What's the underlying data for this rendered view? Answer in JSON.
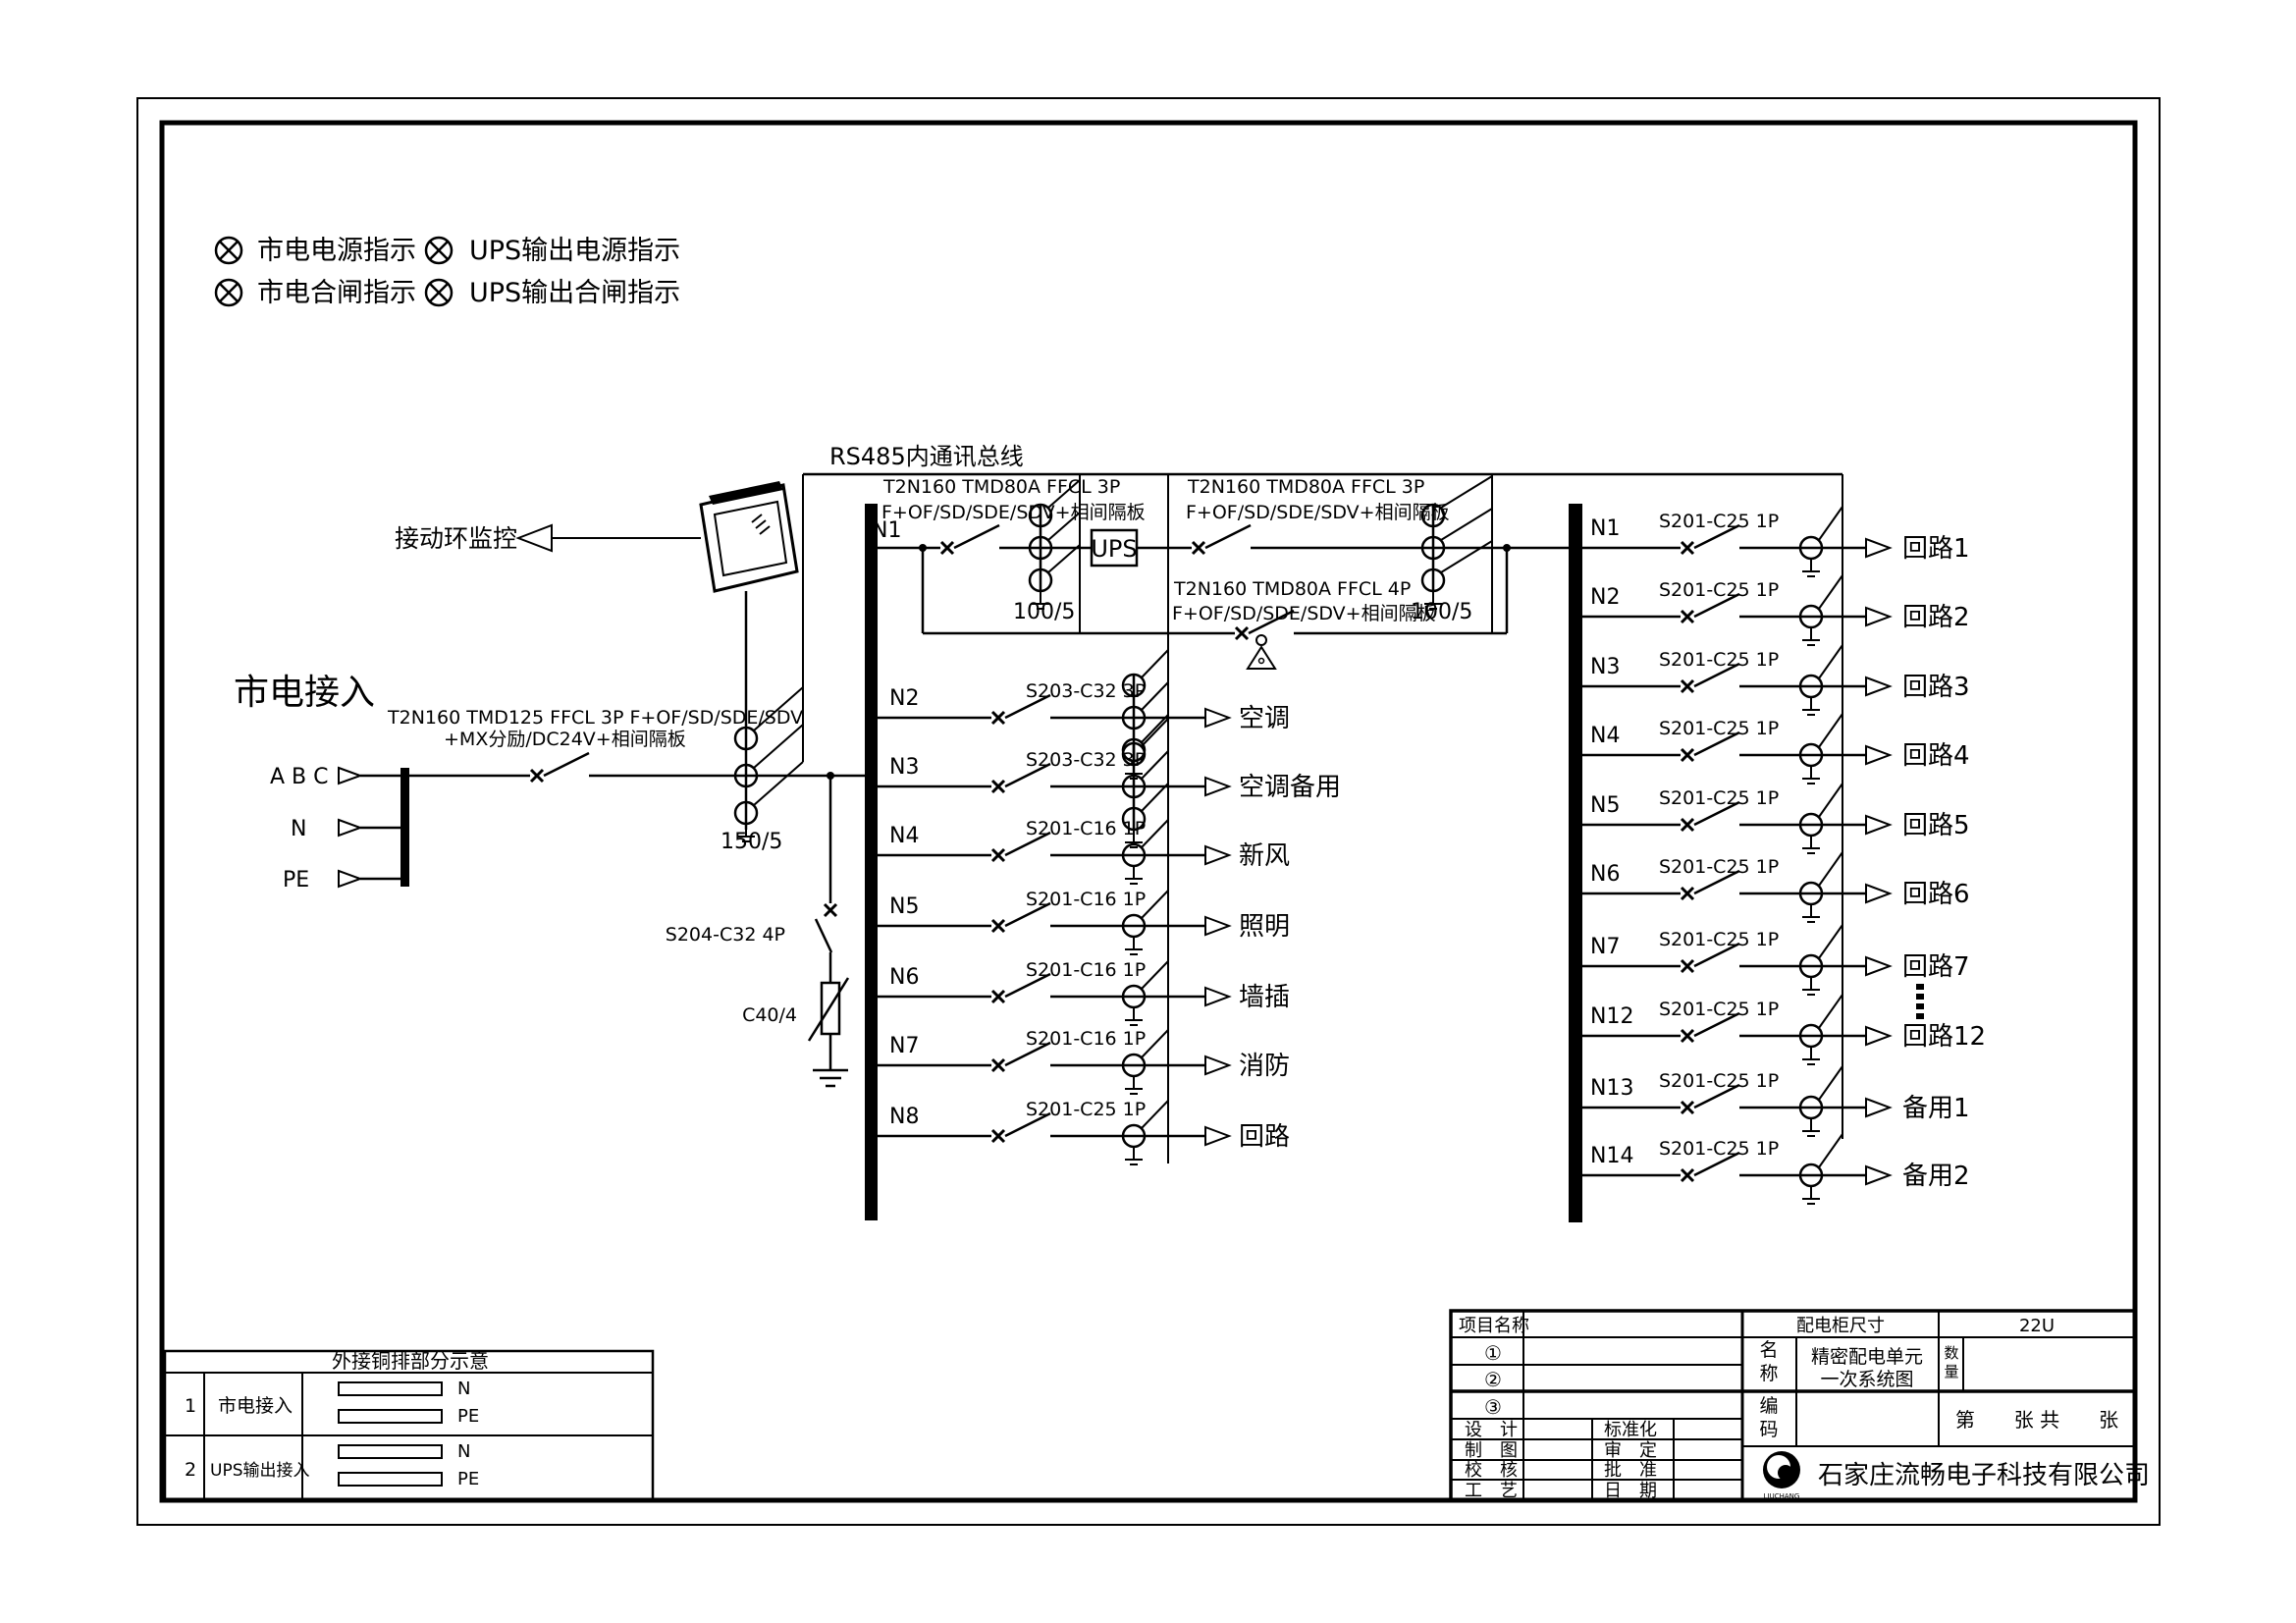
{
  "legend": {
    "item1": "市电电源指示",
    "item2": "UPS输出电源指示",
    "item3": "市电合闸指示",
    "item4": "UPS输出合闸指示"
  },
  "monitoring_label": "接动环监控",
  "rs485_label": "RS485内通讯总线",
  "incoming": {
    "title": "市电接入",
    "phase_label": "A B C",
    "neutral_label": "N",
    "pe_label": "PE",
    "breaker_line1": "T2N160 TMD125 FFCL 3P F+OF/SD/SDE/SDV",
    "breaker_line2": "+MX分励/DC24V+相间隔板",
    "ct_ratio": "150/5"
  },
  "ups_section": {
    "feeder_id": "N1",
    "input_breaker_line1": "T2N160 TMD80A FFCL 3P",
    "input_breaker_line2": "F+OF/SD/SDE/SDV+相间隔板",
    "input_ct_ratio": "100/5",
    "ups_label": "UPS",
    "output_breaker_line1": "T2N160 TMD80A FFCL 3P",
    "output_breaker_line2": "F+OF/SD/SDE/SDV+相间隔板",
    "output_ct_ratio": "100/5",
    "bypass_breaker_line1": "T2N160 TMD80A FFCL 4P",
    "bypass_breaker_line2": "F+OF/SD/SDE/SDV+相间隔板"
  },
  "surge": {
    "breaker": "S204-C32 4P",
    "arrester": "C40/4"
  },
  "mains_panel": {
    "rows": [
      {
        "id": "N2",
        "breaker": "S203-C32 3P",
        "poles": 3,
        "load": "空调"
      },
      {
        "id": "N3",
        "breaker": "S203-C32 3P",
        "poles": 3,
        "load": "空调备用"
      },
      {
        "id": "N4",
        "breaker": "S201-C16 1P",
        "poles": 1,
        "load": "新风"
      },
      {
        "id": "N5",
        "breaker": "S201-C16 1P",
        "poles": 1,
        "load": "照明"
      },
      {
        "id": "N6",
        "breaker": "S201-C16 1P",
        "poles": 1,
        "load": "墙插"
      },
      {
        "id": "N7",
        "breaker": "S201-C16 1P",
        "poles": 1,
        "load": "消防"
      },
      {
        "id": "N8",
        "breaker": "S201-C25 1P",
        "poles": 1,
        "load": "回路"
      }
    ]
  },
  "ups_panel": {
    "rows": [
      {
        "id": "N1",
        "breaker": "S201-C25 1P",
        "load": "回路1"
      },
      {
        "id": "N2",
        "breaker": "S201-C25 1P",
        "load": "回路2"
      },
      {
        "id": "N3",
        "breaker": "S201-C25 1P",
        "load": "回路3"
      },
      {
        "id": "N4",
        "breaker": "S201-C25 1P",
        "load": "回路4"
      },
      {
        "id": "N5",
        "breaker": "S201-C25 1P",
        "load": "回路5"
      },
      {
        "id": "N6",
        "breaker": "S201-C25 1P",
        "load": "回路6"
      },
      {
        "id": "N7",
        "breaker": "S201-C25 1P",
        "load": "回路7"
      },
      {
        "id": "N12",
        "breaker": "S201-C25 1P",
        "load": "回路12"
      },
      {
        "id": "N13",
        "breaker": "S201-C25 1P",
        "load": "备用1"
      },
      {
        "id": "N14",
        "breaker": "S201-C25 1P",
        "load": "备用2"
      }
    ]
  },
  "busbar_table": {
    "title": "外接铜排部分示意",
    "rows": [
      {
        "no": "1",
        "name": "市电接入",
        "bar1": "N",
        "bar2": "PE"
      },
      {
        "no": "2",
        "name": "UPS输出接入",
        "bar1": "N",
        "bar2": "PE"
      }
    ]
  },
  "title_block": {
    "project_label": "项目名称",
    "circle1": "①",
    "circle2": "②",
    "circle3": "③",
    "design_label": "设　计",
    "standard_label": "标准化",
    "draft_label": "制　图",
    "review_label": "审　定",
    "check_label": "校　核",
    "approve_label": "批　准",
    "process_label": "工　艺",
    "date_label": "日　期",
    "cabinet_size_label": "配电柜尺寸",
    "cabinet_size_value": "22U",
    "name_label": "名称",
    "name_line1": "精密配电单元",
    "name_line2": "一次系统图",
    "qty_label": "数量",
    "code_label": "编码",
    "sheet_label": "第　　张 共　　张",
    "company": "石家庄流畅电子科技有限公司",
    "logo_caption": "LIUCHANG"
  }
}
